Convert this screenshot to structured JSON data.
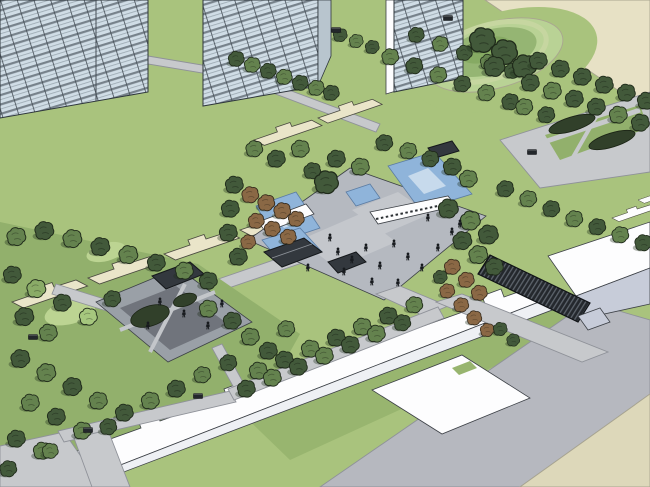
{
  "colors": {
    "lawn": "#a9c37d",
    "lawn2": "#98b56f",
    "lawn3": "#92b06c",
    "lawnHi": "#bcd492",
    "moundRing": "#b9d295",
    "moundMid": "#95b573",
    "moundIn": "#86aa63",
    "beigeTop": "#e7e1c5",
    "beigeBottom": "#ddd8ba",
    "plot": "#eae5c9",
    "road": "#b6b8bf",
    "path": "#c7c9cc",
    "plaza": "#b5b9c0",
    "plazaPanel": "#c4c7cc",
    "courtPave": "#9aa0a7",
    "courtInner": "#70747c",
    "water": "#8fb4da",
    "waterHi": "#c7daec",
    "white": "#fdfdfe",
    "whiteFace": "#eef0f4",
    "boxFace": "#c7ccd9",
    "glass": "#d0dde6",
    "glassSlab": "#77828b",
    "glassLine": "#434c54",
    "glassSide": "#b8c5ce",
    "roof": "#33383e",
    "pergola": "#24282d",
    "pergSlat": "#5d646c",
    "hedge": "#31402a",
    "outline": "#3c4046",
    "treeLight": "#8aab67",
    "treeMid": "#64824e",
    "treeDark": "#42593a",
    "treeBright": "#a6c77e",
    "autumn": "#8a6845",
    "treeStroke": "#1f2a1a",
    "autumnStroke": "#33281a",
    "figure": "#171a1e",
    "bench": "#23272b",
    "shadow": "rgba(30,46,26,0.35)"
  },
  "scene": {
    "trees": [
      [
        236,
        60,
        0.8,
        3
      ],
      [
        252,
        66,
        0.8,
        2
      ],
      [
        268,
        72,
        0.8,
        3
      ],
      [
        284,
        78,
        0.8,
        2
      ],
      [
        300,
        84,
        0.8,
        3
      ],
      [
        316,
        89,
        0.8,
        2
      ],
      [
        331,
        94,
        0.8,
        3
      ],
      [
        340,
        36,
        0.7,
        3
      ],
      [
        356,
        42,
        0.7,
        2
      ],
      [
        372,
        48,
        0.7,
        3
      ],
      [
        390,
        58,
        0.85,
        2
      ],
      [
        414,
        67,
        0.85,
        3
      ],
      [
        438,
        76,
        0.85,
        2
      ],
      [
        462,
        85,
        0.85,
        3
      ],
      [
        486,
        94,
        0.85,
        2
      ],
      [
        510,
        103,
        0.85,
        3
      ],
      [
        416,
        36,
        0.8,
        3
      ],
      [
        440,
        45,
        0.8,
        2
      ],
      [
        464,
        54,
        0.8,
        3
      ],
      [
        488,
        63,
        0.8,
        2
      ],
      [
        512,
        72,
        0.8,
        3
      ],
      [
        482,
        42,
        1.3,
        3
      ],
      [
        504,
        54,
        1.3,
        3
      ],
      [
        524,
        68,
        1.2,
        3
      ],
      [
        494,
        68,
        1.05,
        3
      ],
      [
        538,
        62,
        0.9,
        3
      ],
      [
        560,
        70,
        0.9,
        3
      ],
      [
        582,
        78,
        0.9,
        3
      ],
      [
        604,
        86,
        0.9,
        3
      ],
      [
        626,
        94,
        0.9,
        3
      ],
      [
        646,
        102,
        0.9,
        3
      ],
      [
        530,
        84,
        0.9,
        3
      ],
      [
        552,
        92,
        0.9,
        2
      ],
      [
        574,
        100,
        0.9,
        3
      ],
      [
        596,
        108,
        0.9,
        3
      ],
      [
        618,
        116,
        0.9,
        2
      ],
      [
        640,
        124,
        0.9,
        3
      ],
      [
        524,
        108,
        0.85,
        2
      ],
      [
        546,
        116,
        0.85,
        3
      ],
      [
        505,
        190,
        0.85,
        3
      ],
      [
        528,
        200,
        0.85,
        2
      ],
      [
        551,
        210,
        0.85,
        3
      ],
      [
        574,
        220,
        0.85,
        2
      ],
      [
        597,
        228,
        0.85,
        3
      ],
      [
        620,
        236,
        0.85,
        2
      ],
      [
        643,
        244,
        0.85,
        3
      ],
      [
        448,
        210,
        1,
        3
      ],
      [
        470,
        222,
        1,
        2
      ],
      [
        488,
        236,
        1,
        3
      ],
      [
        462,
        242,
        0.95,
        3
      ],
      [
        478,
        256,
        0.95,
        2
      ],
      [
        494,
        268,
        0.9,
        3
      ],
      [
        452,
        168,
        0.9,
        3
      ],
      [
        468,
        180,
        0.9,
        2
      ],
      [
        250,
        196,
        0.85,
        4
      ],
      [
        266,
        204,
        0.85,
        4
      ],
      [
        282,
        212,
        0.85,
        4
      ],
      [
        296,
        220,
        0.8,
        4
      ],
      [
        256,
        222,
        0.8,
        4
      ],
      [
        272,
        230,
        0.8,
        4
      ],
      [
        288,
        238,
        0.8,
        4
      ],
      [
        248,
        243,
        0.75,
        4
      ],
      [
        234,
        186,
        0.9,
        3
      ],
      [
        230,
        210,
        0.9,
        3
      ],
      [
        228,
        234,
        0.9,
        3
      ],
      [
        238,
        258,
        0.9,
        3
      ],
      [
        300,
        150,
        0.9,
        2
      ],
      [
        276,
        160,
        0.9,
        3
      ],
      [
        254,
        150,
        0.85,
        2
      ],
      [
        312,
        172,
        0.85,
        3
      ],
      [
        336,
        160,
        0.9,
        3
      ],
      [
        360,
        168,
        0.9,
        2
      ],
      [
        384,
        144,
        0.85,
        3
      ],
      [
        408,
        152,
        0.85,
        2
      ],
      [
        430,
        160,
        0.85,
        3
      ],
      [
        326,
        184,
        1.2,
        3
      ],
      [
        452,
        268,
        0.8,
        4
      ],
      [
        466,
        281,
        0.8,
        4
      ],
      [
        479,
        294,
        0.8,
        4
      ],
      [
        447,
        292,
        0.75,
        4
      ],
      [
        461,
        306,
        0.75,
        4
      ],
      [
        474,
        319,
        0.75,
        4
      ],
      [
        487,
        331,
        0.7,
        4
      ],
      [
        440,
        278,
        0.7,
        3
      ],
      [
        500,
        330,
        0.7,
        3
      ],
      [
        513,
        341,
        0.65,
        3
      ],
      [
        258,
        372,
        0.9,
        2
      ],
      [
        284,
        361,
        0.9,
        3
      ],
      [
        310,
        350,
        0.9,
        2
      ],
      [
        336,
        339,
        0.9,
        3
      ],
      [
        362,
        328,
        0.9,
        2
      ],
      [
        388,
        317,
        0.9,
        3
      ],
      [
        414,
        306,
        0.85,
        2
      ],
      [
        246,
        390,
        0.9,
        3
      ],
      [
        272,
        379,
        0.9,
        2
      ],
      [
        298,
        368,
        0.9,
        3
      ],
      [
        324,
        357,
        0.9,
        2
      ],
      [
        350,
        346,
        0.9,
        3
      ],
      [
        376,
        335,
        0.9,
        2
      ],
      [
        402,
        324,
        0.85,
        3
      ],
      [
        16,
        238,
        0.95,
        2
      ],
      [
        44,
        232,
        0.95,
        3
      ],
      [
        72,
        240,
        0.95,
        2
      ],
      [
        100,
        248,
        0.95,
        3
      ],
      [
        128,
        256,
        0.95,
        2
      ],
      [
        156,
        264,
        0.9,
        3
      ],
      [
        184,
        272,
        0.9,
        2
      ],
      [
        208,
        282,
        0.9,
        3
      ],
      [
        12,
        276,
        0.9,
        3
      ],
      [
        36,
        290,
        0.95,
        1
      ],
      [
        62,
        304,
        0.9,
        3
      ],
      [
        88,
        318,
        0.9,
        5
      ],
      [
        24,
        318,
        0.95,
        3
      ],
      [
        48,
        334,
        0.9,
        2
      ],
      [
        112,
        300,
        0.85,
        3
      ],
      [
        208,
        310,
        0.9,
        2
      ],
      [
        232,
        322,
        0.9,
        3
      ],
      [
        250,
        338,
        0.9,
        2
      ],
      [
        268,
        352,
        0.9,
        3
      ],
      [
        286,
        330,
        0.85,
        2
      ],
      [
        20,
        360,
        0.95,
        3
      ],
      [
        46,
        374,
        0.95,
        2
      ],
      [
        72,
        388,
        0.95,
        3
      ],
      [
        98,
        402,
        0.9,
        2
      ],
      [
        124,
        414,
        0.9,
        3
      ],
      [
        150,
        402,
        0.9,
        2
      ],
      [
        176,
        390,
        0.9,
        3
      ],
      [
        30,
        404,
        0.9,
        2
      ],
      [
        56,
        418,
        0.9,
        3
      ],
      [
        82,
        432,
        0.9,
        2
      ],
      [
        16,
        440,
        0.9,
        3
      ],
      [
        42,
        452,
        0.9,
        2
      ],
      [
        108,
        428,
        0.85,
        3
      ],
      [
        202,
        376,
        0.85,
        2
      ],
      [
        228,
        364,
        0.85,
        3
      ],
      [
        8,
        470,
        0.85,
        3
      ],
      [
        50,
        452,
        0.8,
        2
      ]
    ],
    "people": [
      [
        338,
        252
      ],
      [
        352,
        260
      ],
      [
        366,
        248
      ],
      [
        380,
        266
      ],
      [
        394,
        244
      ],
      [
        408,
        257
      ],
      [
        422,
        268
      ],
      [
        438,
        248
      ],
      [
        372,
        282
      ],
      [
        398,
        283
      ],
      [
        452,
        232
      ],
      [
        330,
        238
      ],
      [
        308,
        268
      ],
      [
        428,
        218
      ],
      [
        460,
        224
      ],
      [
        344,
        272
      ],
      [
        160,
        302
      ],
      [
        184,
        314
      ],
      [
        208,
        326
      ],
      [
        148,
        326
      ],
      [
        222,
        304
      ]
    ],
    "plots": [
      [
        12,
        302,
        1,
        1
      ],
      [
        88,
        278,
        1,
        1
      ],
      [
        164,
        254,
        1,
        1
      ],
      [
        240,
        230,
        1,
        1
      ],
      [
        254,
        140,
        0.9,
        1
      ],
      [
        318,
        118,
        0.85,
        1
      ],
      [
        612,
        218,
        0.6,
        2
      ],
      [
        638,
        200,
        0.55,
        2
      ]
    ],
    "benches": [
      [
        88,
        430
      ],
      [
        198,
        396
      ],
      [
        336,
        30
      ],
      [
        532,
        152
      ],
      [
        33,
        337
      ],
      [
        448,
        18
      ]
    ]
  }
}
